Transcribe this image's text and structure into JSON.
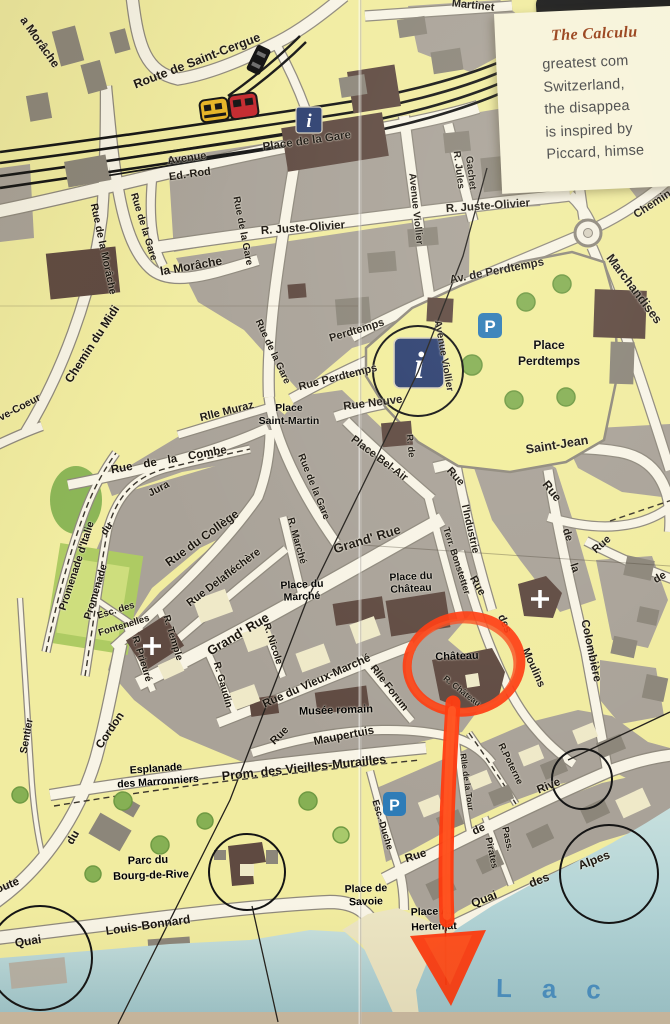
{
  "card": {
    "title": "The Calculu",
    "lines": [
      "greatest com",
      "Switzerland,",
      "the disappea",
      "is inspired by",
      "Piccard, himse"
    ]
  },
  "icons": {
    "info": "i",
    "parking": "P"
  },
  "lake": {
    "name": "Lac"
  },
  "labels": {
    "martinet": "Martinet",
    "route_de_saint_cergue": "Route de Saint-Cergue",
    "rue_de_la_morache": "Rue de la Morâche",
    "a_morache": "a Morâche",
    "la_morache": "la Morâche",
    "avenue": "Avenue",
    "ed_rod": "Ed.-Rod",
    "place_de_la_gare": "Place de la Gare",
    "r_jules": "R. Jules",
    "gachet": "Gachet",
    "avenue_viollier": "Avenue Viollier",
    "r_juste_olivier": "R. Juste-Olivier",
    "chemin": "Chemin",
    "marchandises": "Marchandises",
    "av_de_perdtemps": "Av. de Perdtemps",
    "perdtemps": "Perdtemps",
    "rue_perdtemps": "Rue Perdtemps",
    "rue_neuve": "Rue Neuve",
    "place": "Place",
    "saint_martin": "Saint-Martin",
    "rlle_muraz": "Rlle Muraz",
    "place_bel_air": "Place Bel-Air",
    "r_de": "R. de",
    "saint_jean": "Saint-Jean",
    "rue": "Rue",
    "l_industrie": "l'Industrie",
    "de": "de",
    "la": "la",
    "colombiere": "Colombière",
    "terr_bonstetter": "Terr. Bonstetter",
    "des": "des",
    "moulins": "Moulins",
    "place_du": "Place du",
    "chateau": "Château",
    "grand_rue": "Grand' Rue",
    "rue_du_college": "Rue du Collège",
    "rue_delafléchere": "Rue Delafléchère",
    "r_marche": "R. Marché",
    "marche": "Marché",
    "esc_des": "Esc. des",
    "fontenelles": "Fontenelles",
    "r_temple": "R. Temple",
    "r_prieure": "R. Prieuré",
    "r_nicole": "R. Nicole",
    "r_gaudin": "R. Gaudin",
    "rue_du_vieux_marche": "Rue du Vieux-Marché",
    "rlle_forum": "Rlle Forum",
    "musee_romain": "Musée romain",
    "maupertuis": "Maupertuis",
    "prom_des_vieilles_murailles": "Prom. des Vieilles-Murailles",
    "esplanade": "Esplanade",
    "des_marronniers": "des Marronniers",
    "cordon": "Cordon",
    "du": "du",
    "route": "Route",
    "sentier": "Sentier",
    "promenade_d_italie": "Promenade d'Italie",
    "promenade": "Promenade",
    "jura": "Jura",
    "rue_de_la_combe": "Rue de la Combe",
    "chemin_du_midi": "Chemin du Midi",
    "creve_coeur": "Crève-Coeur",
    "rue_de_la_gare": "Rue de la Gare",
    "esc_duche": "Esc.-Duche",
    "rive": "Rive",
    "pass": "Pass.",
    "pirates": "Pirates",
    "quai": "Quai",
    "alpes": "Alpes",
    "louis_bonnard": "Louis-Bonnard",
    "place_de": "Place de",
    "savoie": "Savoie",
    "place_a": "Place A.",
    "hertenjat": "Hertenjat",
    "parc_du": "Parc du",
    "bourg_de_rive": "Bourg-de-Rive",
    "r_poterne": "R.Poterne",
    "rlle_de_la_tour": "Rlle de la Tour",
    "r_chateau": "R. Château"
  }
}
